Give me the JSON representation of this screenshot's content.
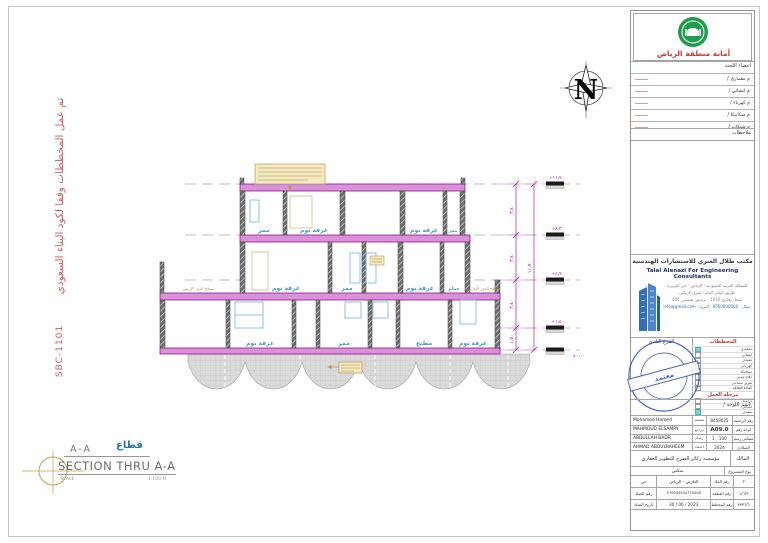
{
  "page": {
    "left_note": "تم عمل المخططات وفقا لكود البناء السعودي",
    "left_code": "SBC-1101"
  },
  "drawing_title": {
    "name_ar": "قطاع",
    "ref": "A-A",
    "name_en": "SECTION THRU A-A",
    "scale_label": "SCALE :",
    "scale_value": "1:100 M"
  },
  "north_letter": "N",
  "section": {
    "rooms": {
      "f2": [
        "ممر",
        "غرفة نوم",
        "غرفة نوم",
        "ممر"
      ],
      "f1": [
        "غرفة نوم",
        "ممر",
        "غرفة نوم",
        "حمام"
      ],
      "g": [
        "غرفة نوم",
        "ممر",
        "مطبخ",
        "غرفة نوم"
      ],
      "roof_left": "سطح الدور الأرضي",
      "roof_right": "سطح الدور الأول"
    },
    "levels": [
      "+١١٫٧٠",
      "+٨٫٣٠",
      "+٤٫٩٠",
      "+١٫٥٠",
      "±٠٫٠٠"
    ],
    "dims": [
      "٣٫٤٠",
      "٣٫٤٠",
      "٣٫٤٠",
      "١٫٥٠"
    ],
    "dim_total": "١١٫٧٠"
  },
  "titleblock": {
    "municipality": {
      "name": "أمانة منطقة الرياض"
    },
    "committee": {
      "header": "اعضاء اللجنة",
      "rows": [
        {
          "label": "م   معماري   /"
        },
        {
          "label": "م   انشائي   /"
        },
        {
          "label": "م   كهرباء   /"
        },
        {
          "label": "م   ميكانيكا   /"
        },
        {
          "label": "م   شبكات   /"
        }
      ],
      "notes_label": "ملاحظات"
    },
    "consultant": {
      "name_ar": "مكتب طلال العنزي للاستشارات الهندسية",
      "name_en": "Talal Alenazi For Engineering Consultants",
      "addr1": "المملكة العربية السعودية - الرياض - حي العزيزية",
      "addr2": "طريق الحاير العام - شرق الرياض",
      "addr3": "سجل تجاري 1010 - ترخيص هندسي 404",
      "addr4": "جوال : 0550000000 - البريد : info@gmail.com"
    },
    "checklist": {
      "left_header": "الفرع البلدي",
      "right_header": "المخططات",
      "items": [
        {
          "label": "معماري",
          "checked": true
        },
        {
          "label": "انشائي",
          "checked": false
        },
        {
          "label": "تنفيذي",
          "checked": false
        },
        {
          "label": "كهربائي",
          "checked": false
        },
        {
          "label": "ميكانيكا",
          "checked": false
        },
        {
          "label": "دفاع مدني",
          "checked": false
        },
        {
          "label": "تقرير مساحي",
          "checked": false
        },
        {
          "label": "كفاءة الطاقة",
          "checked": false
        }
      ],
      "phase_header": "مرحلة العمل",
      "phases": [
        {
          "label": "دراسة",
          "checked": false
        },
        {
          "label": "ابتدائي",
          "checked": false
        },
        {
          "label": "تنفيذي",
          "checked": true
        }
      ]
    },
    "stamp": {
      "ring": "مكتب طلال العنزي للاستشارات الهندسية",
      "banner": "معتمد"
    },
    "sheetname_label": "اسم اللوحة   /",
    "personnel": [
      {
        "name": "Mohamed Hamed",
        "role": "مصمم",
        "label": "رقم الرخصة",
        "value": "B409025"
      },
      {
        "name": "MAHMOUD ELSAMRY",
        "role": "مراجع",
        "label": "لوحة رقم",
        "value": "A09.0"
      },
      {
        "name": "ABDULLAH BADR",
        "role": "رسام",
        "label": "مقياس رسم",
        "value": "1 : 100"
      },
      {
        "name": "AHMAD ABDULRAHEEM",
        "role": "اعتماد",
        "label": "الميلادي",
        "value": "2024"
      }
    ],
    "owner": {
      "label": "المالك",
      "value": "مؤسسة ركائز الصرح للتطوير العقاري"
    },
    "project": {
      "label": "نوع المشروع",
      "value": "سكني"
    },
    "parcel": [
      {
        "l1": "حي",
        "v1": "العارض - الرياض",
        "l2": "رقم البلك",
        "v2": "٢"
      },
      {
        "l1": "رقم الصك",
        "v1": "370044554770008",
        "l2": "رقم القطعة",
        "v2": "١/٦/٣"
      },
      {
        "l1": "تاريخ الصك",
        "v1": "30 / 06 / 2023",
        "l2": "رقم المخطط",
        "v2": "٣٣٣٦/١"
      }
    ]
  }
}
